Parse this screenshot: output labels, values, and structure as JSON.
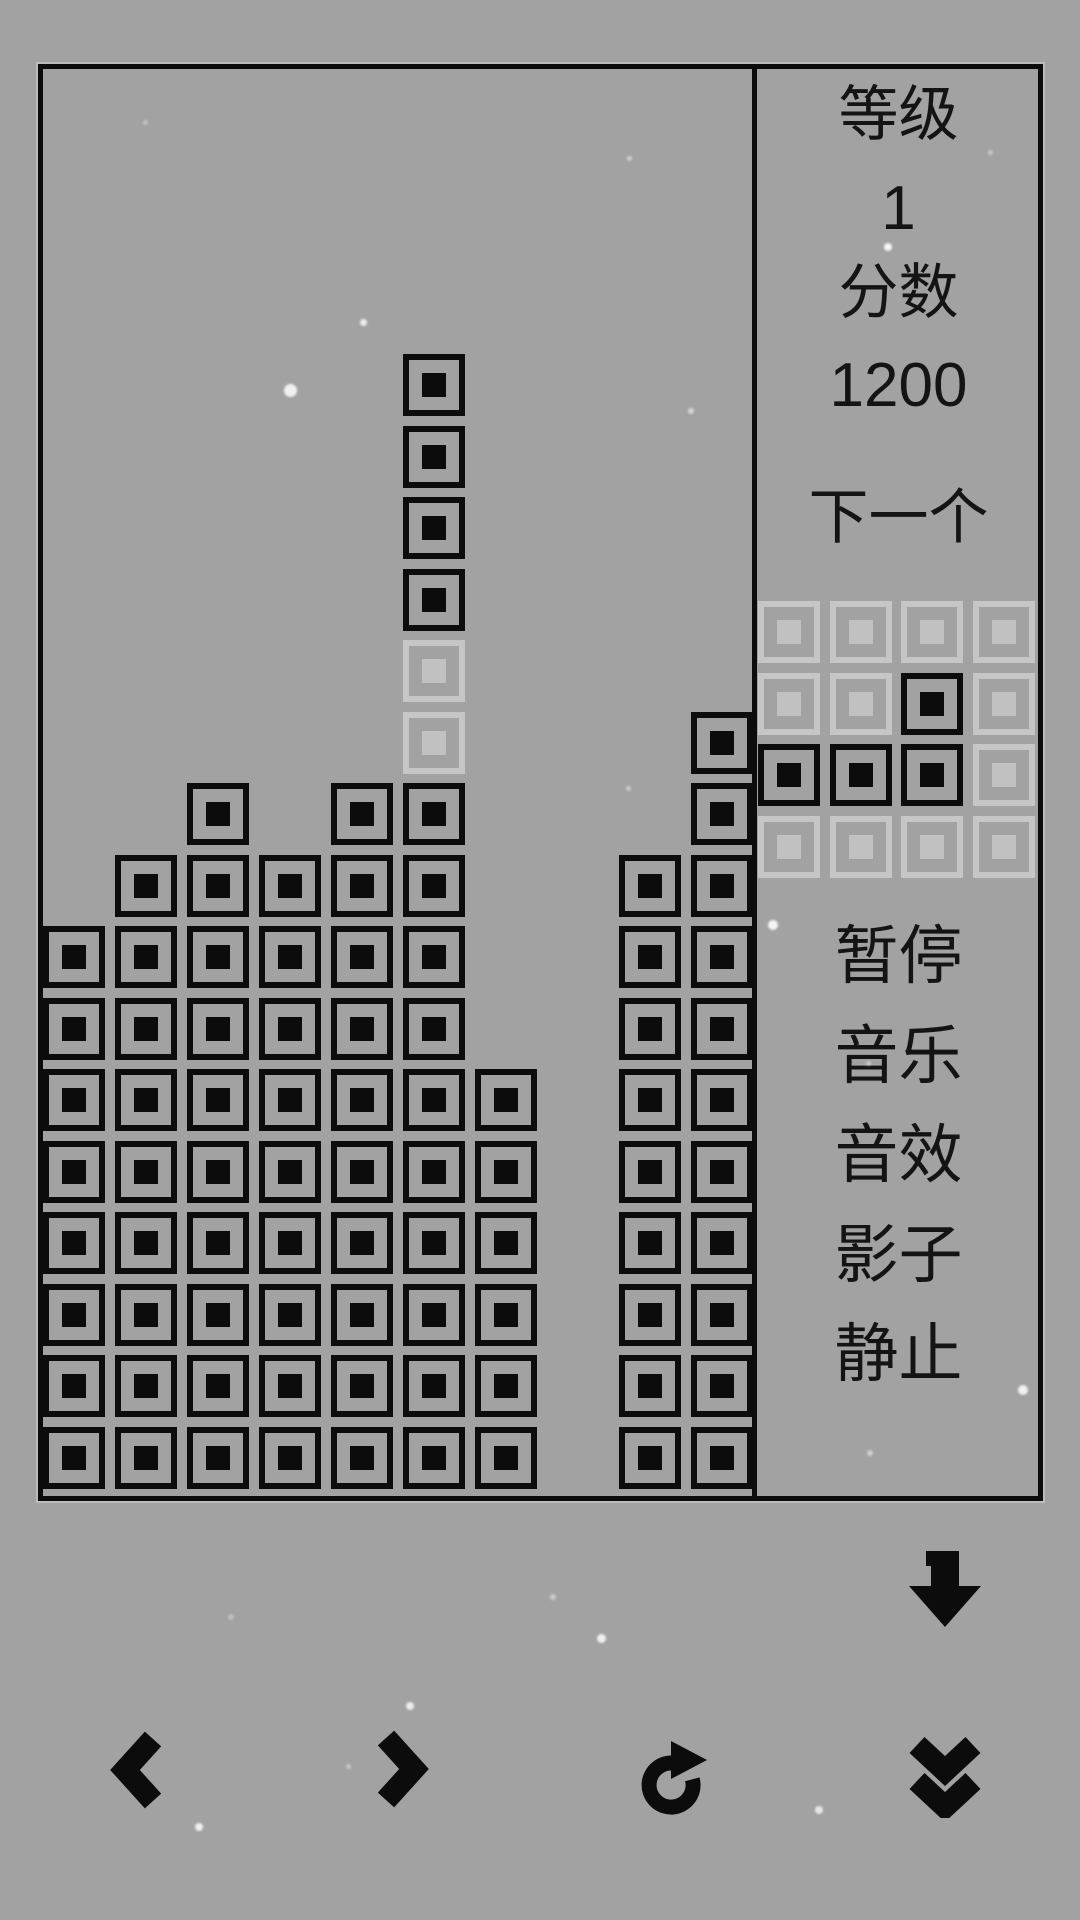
{
  "colors": {
    "background": "#a2a2a2",
    "block": "#0c0c0c",
    "ghost_border": "#c6c6c6",
    "ghost_dot": "#c1c1c1",
    "text": "#141414",
    "particle": "#ffffff"
  },
  "board": {
    "columns": 10,
    "rows": 20,
    "grid": [
      "..........",
      "..........",
      "..........",
      "..........",
      ".....X....",
      ".....X....",
      ".....X....",
      ".....X....",
      ".....G....",
      ".....G...X",
      "..X.XX...X",
      ".XXXXX..XX",
      "XXXXXX..XX",
      "XXXXXX..XX",
      "XXXXXXX.XX",
      "XXXXXXX.XX",
      "XXXXXXX.XX",
      "XXXXXXX.XX",
      "XXXXXXX.XX",
      "XXXXXXX.XX"
    ]
  },
  "sidebar": {
    "level_label": "等级",
    "level_value": "1",
    "score_label": "分数",
    "score_value": "1200",
    "next_label": "下一个",
    "next_preview": [
      "GGGG",
      "GGXG",
      "XXXG",
      "GGGG"
    ],
    "menu": [
      {
        "id": "pause",
        "label": "暂停"
      },
      {
        "id": "music",
        "label": "音乐"
      },
      {
        "id": "sound",
        "label": "音效"
      },
      {
        "id": "shadow",
        "label": "影子"
      },
      {
        "id": "still",
        "label": "静止"
      }
    ]
  },
  "controls": [
    {
      "id": "soft-drop",
      "icon": "arrow-down-icon"
    },
    {
      "id": "move-left",
      "icon": "chevron-left-icon"
    },
    {
      "id": "move-right",
      "icon": "chevron-right-icon"
    },
    {
      "id": "rotate",
      "icon": "rotate-clockwise-icon"
    },
    {
      "id": "hard-drop",
      "icon": "double-chevron-down-icon"
    }
  ],
  "particles": [
    {
      "x": 145,
      "y": 122,
      "s": 5,
      "o": 0.35
    },
    {
      "x": 363,
      "y": 322,
      "s": 7,
      "o": 0.8
    },
    {
      "x": 290,
      "y": 390,
      "s": 13,
      "o": 0.85
    },
    {
      "x": 629,
      "y": 158,
      "s": 5,
      "o": 0.5
    },
    {
      "x": 691,
      "y": 411,
      "s": 6,
      "o": 0.55
    },
    {
      "x": 888,
      "y": 247,
      "s": 8,
      "o": 0.9
    },
    {
      "x": 990,
      "y": 152,
      "s": 5,
      "o": 0.4
    },
    {
      "x": 773,
      "y": 925,
      "s": 10,
      "o": 0.9
    },
    {
      "x": 628,
      "y": 788,
      "s": 5,
      "o": 0.45
    },
    {
      "x": 868,
      "y": 1063,
      "s": 5,
      "o": 0.4
    },
    {
      "x": 1023,
      "y": 1390,
      "s": 10,
      "o": 0.85
    },
    {
      "x": 870,
      "y": 1453,
      "s": 6,
      "o": 0.5
    },
    {
      "x": 601,
      "y": 1638,
      "s": 9,
      "o": 0.85
    },
    {
      "x": 410,
      "y": 1706,
      "s": 8,
      "o": 0.8
    },
    {
      "x": 348,
      "y": 1766,
      "s": 5,
      "o": 0.4
    },
    {
      "x": 819,
      "y": 1810,
      "s": 8,
      "o": 0.75
    },
    {
      "x": 199,
      "y": 1827,
      "s": 8,
      "o": 0.85
    },
    {
      "x": 553,
      "y": 1597,
      "s": 6,
      "o": 0.45
    },
    {
      "x": 231,
      "y": 1617,
      "s": 6,
      "o": 0.3
    }
  ]
}
